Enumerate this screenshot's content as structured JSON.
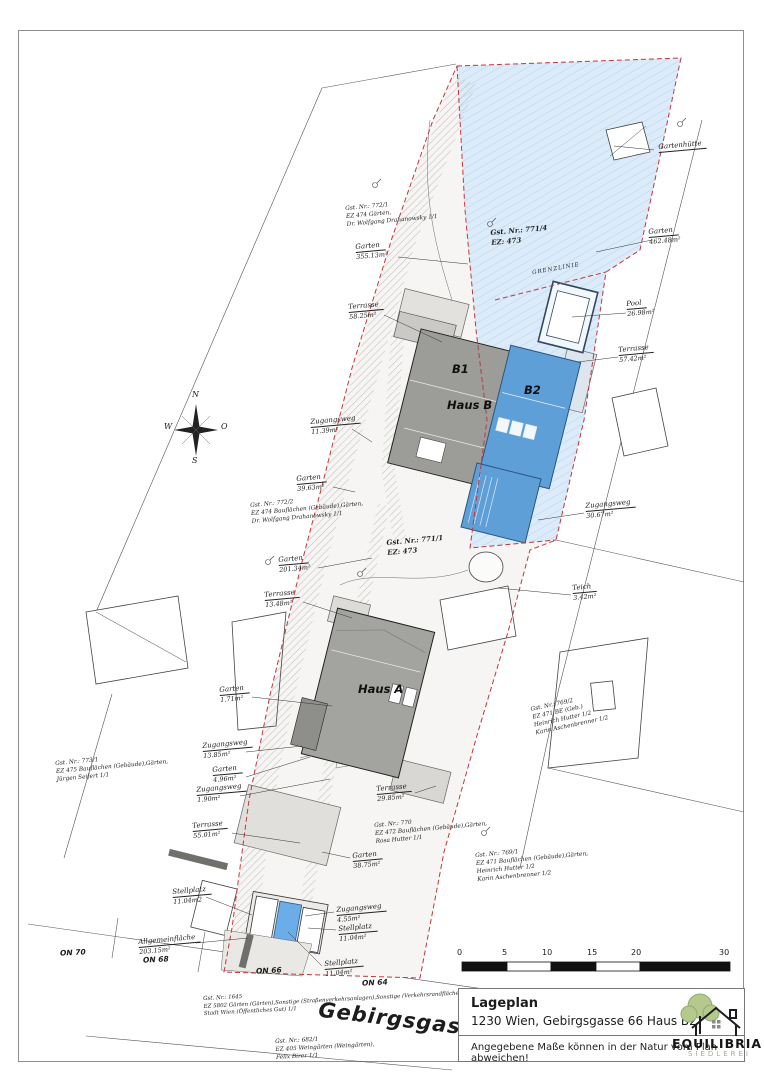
{
  "title_block": {
    "title": "Lageplan",
    "address": "1230 Wien, Gebirgsgasse 66 Haus B2",
    "disclaimer": "Angegebene Maße können in der Natur vom Plan abweichen!",
    "logo_name": "EQUILIBRIA",
    "logo_subtitle": "SIEDLEREI"
  },
  "scale_bar": {
    "ticks": [
      "0",
      "5",
      "10",
      "15",
      "20",
      "30"
    ]
  },
  "plan": {
    "grenzlinie": "GRENZLINIE",
    "street_name": "Gebirgsgasse",
    "house_numbers": [
      "ON 70",
      "ON 68",
      "ON 66",
      "ON 64"
    ],
    "buildings": {
      "b1": "B1",
      "haus_b": "Haus B",
      "b2": "B2",
      "haus_a": "Haus A"
    },
    "compass": {
      "n": "N",
      "e": "O",
      "s": "S",
      "w": "W"
    }
  },
  "area_labels": [
    {
      "name": "Gartenhütte",
      "area": ""
    },
    {
      "name": "Garten",
      "area": "462.48m²"
    },
    {
      "name": "Garten",
      "area": "355.13m²"
    },
    {
      "name": "Pool",
      "area": "26.98m²"
    },
    {
      "name": "Terrasse",
      "area": "58.25m²"
    },
    {
      "name": "Terrasse",
      "area": "57.42m²"
    },
    {
      "name": "Zugangsweg",
      "area": "11.39m²"
    },
    {
      "name": "Garten",
      "area": "39.63m²"
    },
    {
      "name": "Zugangsweg",
      "area": "30.67m²"
    },
    {
      "name": "Garten",
      "area": "201.34m²"
    },
    {
      "name": "Teich",
      "area": "3.42m²"
    },
    {
      "name": "Terrasse",
      "area": "13.48m²"
    },
    {
      "name": "Garten",
      "area": "1.71m²"
    },
    {
      "name": "Zugangsweg",
      "area": "13.85m²"
    },
    {
      "name": "Garten",
      "area": "4.96m²"
    },
    {
      "name": "Zugangsweg",
      "area": "1.90m²"
    },
    {
      "name": "Terrasse",
      "area": "29.85m²"
    },
    {
      "name": "Terrasse",
      "area": "55.01m²"
    },
    {
      "name": "Garten",
      "area": "38.75m²"
    },
    {
      "name": "Stellplatz",
      "area": "11.04m2"
    },
    {
      "name": "Zugangsweg",
      "area": "4.55m²"
    },
    {
      "name": "Stellplatz",
      "area": "11.04m²"
    },
    {
      "name": "Allgemeinfläche",
      "area": "203.15m²"
    },
    {
      "name": "Stellplatz",
      "area": "11.04m²"
    }
  ],
  "parcels": [
    {
      "lines": [
        "Gst. Nr.: 772/1",
        "EZ 474    Gärten,",
        "Dr. Wolfgang Drahanowsky 1/1"
      ]
    },
    {
      "lines": [
        "Gst. Nr.: 771/4",
        "EZ: 473"
      ]
    },
    {
      "lines": [
        "Gst. Nr.: 772/2",
        "EZ 474    Bauflächen (Gebäude),Gärten,",
        "Dr. Wolfgang Drahanowsky 1/1"
      ]
    },
    {
      "lines": [
        "Gst. Nr.: 771/1",
        "EZ: 473"
      ]
    },
    {
      "lines": [
        "Gst. Nr.: 769/2",
        "EZ 471    BE (Geb.)",
        "Heinrich Hutter 1/2",
        "Karin Aschenbrenner 1/2"
      ]
    },
    {
      "lines": [
        "Gst. Nr.: 773/1",
        "EZ 475    Bauflächen (Gebäude),Gärten,",
        "Jürgen Seifert 1/1"
      ]
    },
    {
      "lines": [
        "Gst. Nr.: 770",
        "EZ 472    Bauflächen (Gebäude),Gärten,",
        "Rosa Hutter 1/1"
      ]
    },
    {
      "lines": [
        "Gst. Nr.: 769/1",
        "EZ 471    Bauflächen (Gebäude),Gärten,",
        "Heinrich Hutter 1/2",
        "Karin Aschenbrenner 1/2"
      ]
    },
    {
      "lines": [
        "Gst. Nr.: 1645",
        "EZ 5802    Gärten (Gärten),Sonstige (Straßenverkehrsanlagen),Sonstige (Verkehrsrandflächen),",
        "Stadt Wien (Öffentliches Gut) 1/1"
      ]
    },
    {
      "lines": [
        "Gst. Nr.: 682/1",
        "EZ 405    Weingärten (Weingärten),",
        "Felix Birer 1/1"
      ]
    }
  ],
  "colors": {
    "boundary_red": "#c4373a",
    "parcel_blue_fill": "#dcebf9",
    "building_blue": "#5f9fd8",
    "building_gray": "#9c9c98",
    "logo_green": "#b5c98f"
  }
}
